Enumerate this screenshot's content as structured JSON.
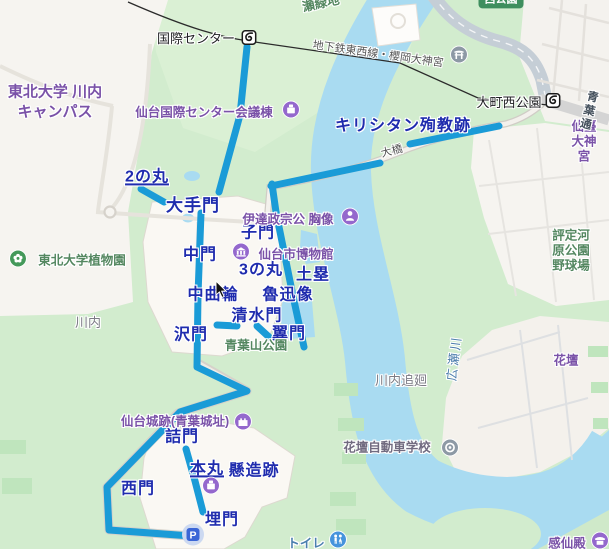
{
  "map": {
    "route": {
      "color": "#1a9bd7",
      "width": 7,
      "segments": [
        [
          [
            247,
            47
          ],
          [
            240,
            115
          ],
          [
            219,
            192
          ]
        ],
        [
          [
            141,
            189
          ],
          [
            164,
            202
          ]
        ],
        [
          [
            271,
            186
          ],
          [
            380,
            163
          ]
        ],
        [
          [
            410,
            144
          ],
          [
            499,
            126
          ]
        ],
        [
          [
            272,
            184
          ],
          [
            276,
            212
          ],
          [
            293,
            296
          ],
          [
            304,
            347
          ]
        ],
        [
          [
            269,
            337
          ],
          [
            257,
            326
          ]
        ],
        [
          [
            237,
            326
          ],
          [
            217,
            325
          ]
        ],
        [
          [
            201,
            213
          ],
          [
            198,
            295
          ],
          [
            197,
            367
          ],
          [
            247,
            391
          ],
          [
            180,
            412
          ],
          [
            107,
            487
          ],
          [
            109,
            530
          ],
          [
            191,
            536
          ]
        ],
        [
          [
            186,
            449
          ],
          [
            195,
            481
          ],
          [
            203,
            512
          ]
        ]
      ]
    },
    "labels": [
      {
        "name": "ninomaru",
        "text": "2の丸",
        "x": 147,
        "y": 177,
        "style": "gate",
        "underline": true,
        "interactable": true
      },
      {
        "name": "otemon",
        "text": "大手門",
        "x": 193,
        "y": 206,
        "style": "gate-lg",
        "interactable": true
      },
      {
        "name": "komon",
        "text": "子門",
        "x": 258,
        "y": 233,
        "style": "gate",
        "interactable": true
      },
      {
        "name": "nakamon",
        "text": "中門",
        "x": 200,
        "y": 255,
        "style": "gate",
        "interactable": true
      },
      {
        "name": "sannomaru",
        "text": "3の丸",
        "x": 261,
        "y": 270,
        "style": "gate",
        "interactable": true
      },
      {
        "name": "dorui",
        "text": "土塁",
        "x": 313,
        "y": 275,
        "style": "gate",
        "interactable": true
      },
      {
        "name": "nakakuruwa",
        "text": "中曲輪",
        "x": 213,
        "y": 295,
        "style": "gate",
        "interactable": true
      },
      {
        "name": "rojinzo",
        "text": "魯迅像",
        "x": 288,
        "y": 295,
        "style": "gate",
        "interactable": true
      },
      {
        "name": "shimizumon",
        "text": "清水門",
        "x": 257,
        "y": 316,
        "style": "gate",
        "interactable": true
      },
      {
        "name": "sawamon",
        "text": "沢門",
        "x": 191,
        "y": 335,
        "style": "gate",
        "interactable": true
      },
      {
        "name": "tsubasamon",
        "text": "翼門",
        "x": 289,
        "y": 334,
        "style": "gate",
        "interactable": true
      },
      {
        "name": "tsumemon",
        "text": "詰門",
        "x": 182,
        "y": 437,
        "style": "gate",
        "interactable": true
      },
      {
        "name": "honmaru",
        "text": "本丸",
        "x": 207,
        "y": 469,
        "style": "gate",
        "underline": true,
        "interactable": true
      },
      {
        "name": "kakezukuri-ato",
        "text": "懸造跡",
        "x": 254,
        "y": 471,
        "style": "gate",
        "interactable": true
      },
      {
        "name": "nishimon",
        "text": "西門",
        "x": 138,
        "y": 489,
        "style": "gate",
        "interactable": true
      },
      {
        "name": "uzumimon",
        "text": "埋門",
        "x": 222,
        "y": 520,
        "style": "gate",
        "interactable": true
      },
      {
        "name": "kirishitan-junkyo-ato",
        "text": "キリシタン殉教跡",
        "x": 403,
        "y": 126,
        "style": "gate",
        "interactable": true
      },
      {
        "name": "intl-center-station",
        "text": "国際センター",
        "x": 196,
        "y": 39,
        "style": "station",
        "interactable": true
      },
      {
        "name": "omachi-nishikoen-station",
        "text": "大町西公園",
        "x": 509,
        "y": 103,
        "style": "station",
        "interactable": true
      },
      {
        "name": "conference-hall",
        "text": "仙台国際センター会議棟",
        "x": 204,
        "y": 113,
        "style": "poi",
        "interactable": true
      },
      {
        "name": "masamune-bust",
        "text": "伊達政宗公 胸像",
        "x": 288,
        "y": 220,
        "style": "poi",
        "interactable": true
      },
      {
        "name": "sendai-city-museum",
        "text": "仙台市博物館",
        "x": 296,
        "y": 255,
        "style": "poi",
        "interactable": true
      },
      {
        "name": "sendai-castle-site",
        "text": "仙台城跡(青葉城址)",
        "x": 175,
        "y": 422,
        "style": "poi",
        "interactable": true
      },
      {
        "name": "kadan",
        "text": "花壇",
        "x": 566,
        "y": 361,
        "style": "poi",
        "interactable": true
      },
      {
        "name": "sendai-daijingu",
        "text": "仙臺大神宮",
        "x": 584,
        "y": 142,
        "style": "poi",
        "interactable": true
      },
      {
        "name": "kansenden",
        "text": "感仙殿",
        "x": 567,
        "y": 544,
        "style": "poi",
        "interactable": true
      },
      {
        "name": "kadan-driving-school",
        "text": "花壇自動車学校",
        "x": 387,
        "y": 448,
        "style": "biz",
        "interactable": true
      },
      {
        "name": "toilet",
        "text": "トイレ",
        "x": 306,
        "y": 544,
        "style": "bluepoi",
        "interactable": true
      },
      {
        "name": "tohoku-univ-botanical-garden",
        "text": "東北大学植物園",
        "x": 82,
        "y": 261,
        "style": "park",
        "interactable": true
      },
      {
        "name": "tohoku-univ-kawauchi-campus",
        "text": "東北大学 川内\nキャンパス",
        "x": 55,
        "y": 102,
        "style": "uni",
        "interactable": false
      },
      {
        "name": "aobayama-park",
        "text": "青葉山公園",
        "x": 256,
        "y": 346,
        "style": "park",
        "interactable": true
      },
      {
        "name": "se-ryokuchi",
        "text": "瀬緑地",
        "x": 321,
        "y": 4,
        "style": "park",
        "rotate": -12,
        "interactable": false
      },
      {
        "name": "hyoteigawara-ballpark",
        "text": "評定河原公園野球場",
        "x": 571,
        "y": 251,
        "style": "park",
        "interactable": true
      },
      {
        "name": "kawauchi",
        "text": "川内",
        "x": 88,
        "y": 323,
        "style": "area",
        "interactable": false
      },
      {
        "name": "kawauchi-oimawashi",
        "text": "川内追廻",
        "x": 401,
        "y": 381,
        "style": "area",
        "interactable": false
      },
      {
        "name": "tozai-subway-line",
        "text": "地下鉄東西線・櫻岡大神宮",
        "x": 378,
        "y": 55,
        "style": "road",
        "rotate": 8,
        "interactable": false
      },
      {
        "name": "aoba-dori",
        "text": "青葉通",
        "x": 589,
        "y": 112,
        "style": "roadbold",
        "rotate": 14,
        "interactable": false
      },
      {
        "name": "ohashi-bridge",
        "text": "大橋",
        "x": 392,
        "y": 152,
        "style": "road",
        "rotate": -14,
        "interactable": false
      },
      {
        "name": "hirose-river",
        "text": "広瀬川",
        "x": 455,
        "y": 358,
        "style": "water",
        "rotate": -83,
        "interactable": false
      },
      {
        "name": "nishi-koen",
        "text": "西公園",
        "x": 501,
        "y": 0,
        "style": "badge",
        "interactable": true
      }
    ],
    "icons": [
      {
        "name": "intl-center-station-icon",
        "kind": "subway",
        "x": 249,
        "y": 40,
        "interactable": true
      },
      {
        "name": "omachi-nishikoen-station-icon",
        "kind": "subway",
        "x": 553,
        "y": 103,
        "interactable": true
      },
      {
        "name": "sakuraoka-shrine-icon",
        "kind": "torii",
        "x": 459,
        "y": 57,
        "interactable": true
      },
      {
        "name": "conference-hall-icon",
        "kind": "conference",
        "x": 291,
        "y": 112,
        "interactable": true
      },
      {
        "name": "masamune-bust-icon",
        "kind": "bust",
        "x": 350,
        "y": 219,
        "interactable": true
      },
      {
        "name": "museum-icon",
        "kind": "museum",
        "x": 241,
        "y": 254,
        "interactable": true
      },
      {
        "name": "castle-site-icon",
        "kind": "castle",
        "x": 243,
        "y": 424,
        "interactable": true
      },
      {
        "name": "honmaru-hall-icon",
        "kind": "hall",
        "x": 211,
        "y": 488,
        "interactable": true
      },
      {
        "name": "botanical-garden-icon",
        "kind": "flower",
        "x": 18,
        "y": 261,
        "interactable": true
      },
      {
        "name": "driving-school-icon",
        "kind": "wheel",
        "x": 450,
        "y": 450,
        "interactable": true
      },
      {
        "name": "restroom-icon",
        "kind": "restroom",
        "x": 338,
        "y": 542,
        "interactable": true
      },
      {
        "name": "kansenden-shrine-icon",
        "kind": "shrine",
        "x": 600,
        "y": 543,
        "interactable": true
      },
      {
        "name": "parking-icon",
        "kind": "parking",
        "x": 193,
        "y": 537,
        "interactable": true
      }
    ]
  }
}
